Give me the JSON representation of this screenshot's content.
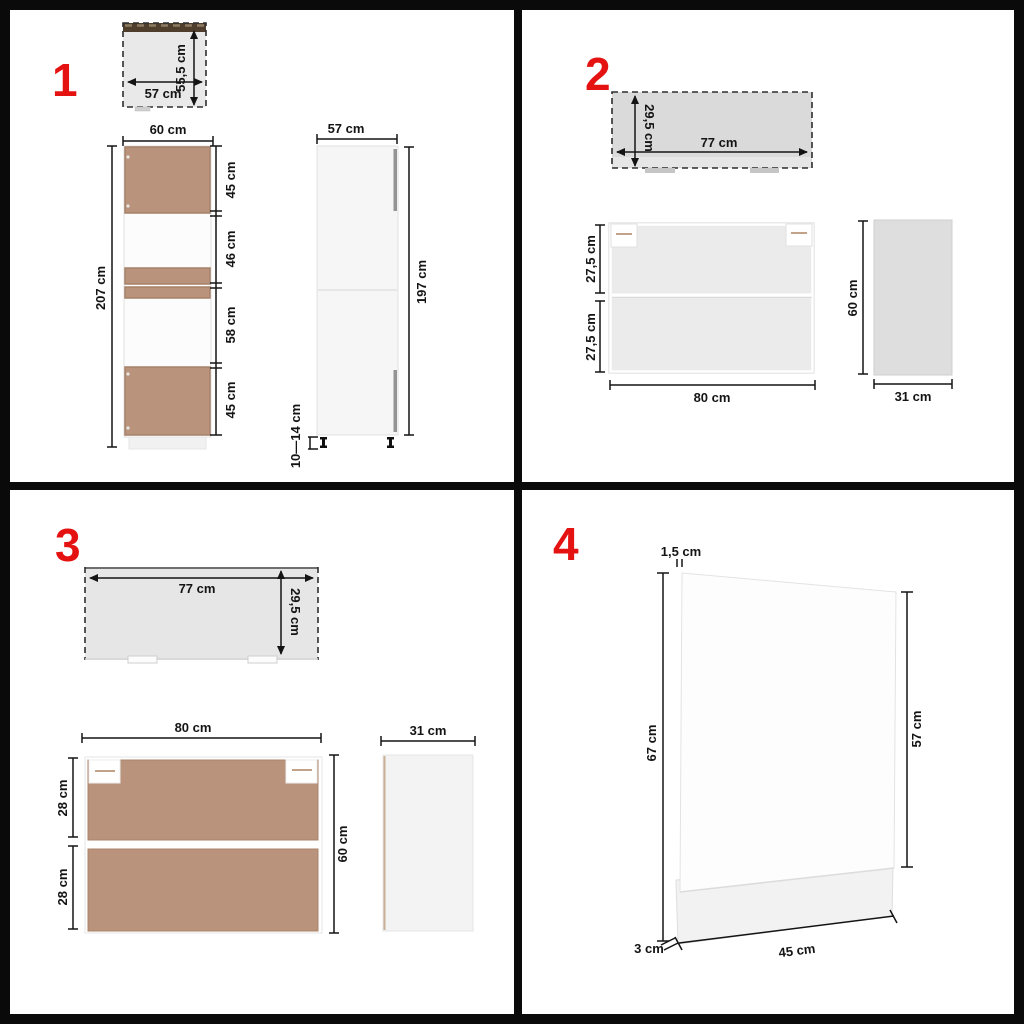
{
  "colors": {
    "background": "#ffffff",
    "frame": "#0a0a0a",
    "accent_red": "#e51212",
    "dimension_line": "#141414",
    "wood": "#b9937b",
    "top_view_grey": "#dadada",
    "dark_top_strip": "#503e2c"
  },
  "quadrants": [
    {
      "number": "1",
      "top_view": {
        "width": "57 cm",
        "depth": "55,5 cm"
      },
      "front_view": {
        "width": "60 cm",
        "height": "207 cm",
        "segments": [
          "45 cm",
          "46 cm",
          "58 cm",
          "45 cm"
        ]
      },
      "side_view": {
        "width": "57 cm",
        "height": "197 cm",
        "legs": "10—14 cm"
      }
    },
    {
      "number": "2",
      "top_view": {
        "width": "77 cm",
        "depth": "29,5 cm"
      },
      "front_view": {
        "width": "80 cm",
        "segments": [
          "27,5 cm",
          "27,5 cm"
        ]
      },
      "side_view": {
        "width": "31 cm",
        "height": "60 cm"
      }
    },
    {
      "number": "3",
      "top_view": {
        "width": "77 cm",
        "depth": "29,5 cm"
      },
      "front_view": {
        "width": "80 cm",
        "height": "60 cm",
        "segments": [
          "28 cm",
          "28 cm"
        ]
      },
      "side_view": {
        "width": "31 cm"
      }
    },
    {
      "number": "4",
      "panel_view": {
        "thickness": "1,5 cm",
        "height": "67 cm",
        "door_height": "57 cm",
        "plinth": "3 cm",
        "width": "45 cm"
      }
    }
  ]
}
